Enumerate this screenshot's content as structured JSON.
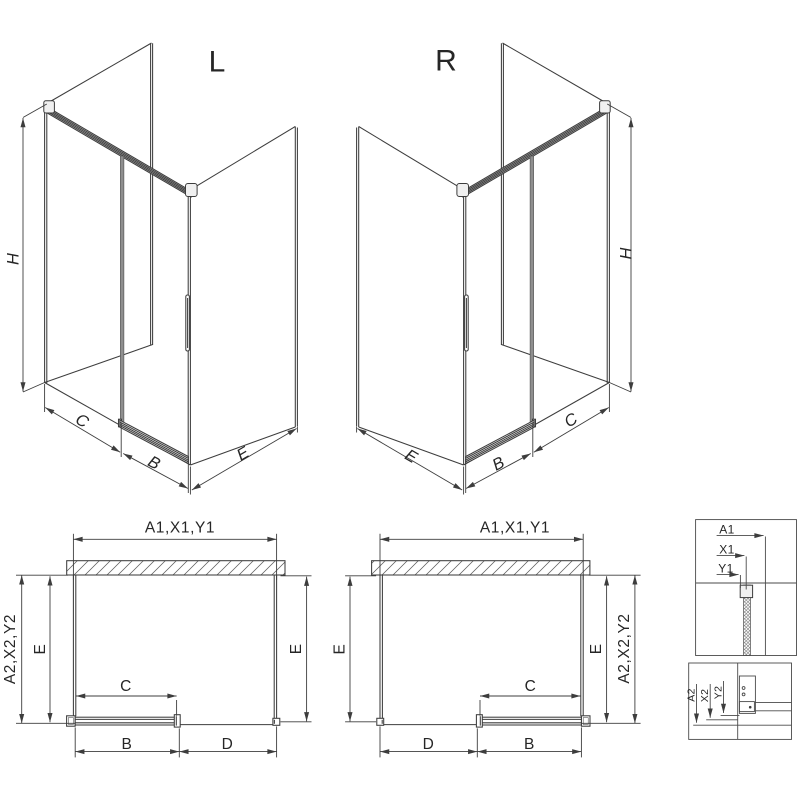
{
  "colors": {
    "line": "#3d3d3d",
    "door_edge_gray": "#8f8f8f",
    "cap_fill": "#f0f0f0",
    "background": "#ffffff"
  },
  "iso_left": {
    "variant_label": "L",
    "height_label": "H",
    "fixed_panel_label": "C",
    "door_label": "B",
    "side_panel_label": "E"
  },
  "iso_right": {
    "variant_label": "R",
    "height_label": "H",
    "fixed_panel_label": "C",
    "door_label": "B",
    "side_panel_label": "E"
  },
  "plan_left": {
    "width_label": "A1,X1,Y1",
    "depth_outer_label": "A2,X2,Y2",
    "side_left_label": "E",
    "side_right_label": "E",
    "door_label": "C",
    "rail_label": "B",
    "opening_label": "D"
  },
  "plan_right": {
    "width_label": "A1,X1,Y1",
    "depth_outer_label": "A2,X2,Y2",
    "side_left_label": "E",
    "side_right_label": "E",
    "door_label": "C",
    "rail_label": "B",
    "opening_label": "D"
  },
  "detail_width": {
    "row1": "A1",
    "row2": "X1",
    "row3": "Y1"
  },
  "detail_depth": {
    "row1": "A2",
    "row2": "X2",
    "row3": "Y2"
  }
}
